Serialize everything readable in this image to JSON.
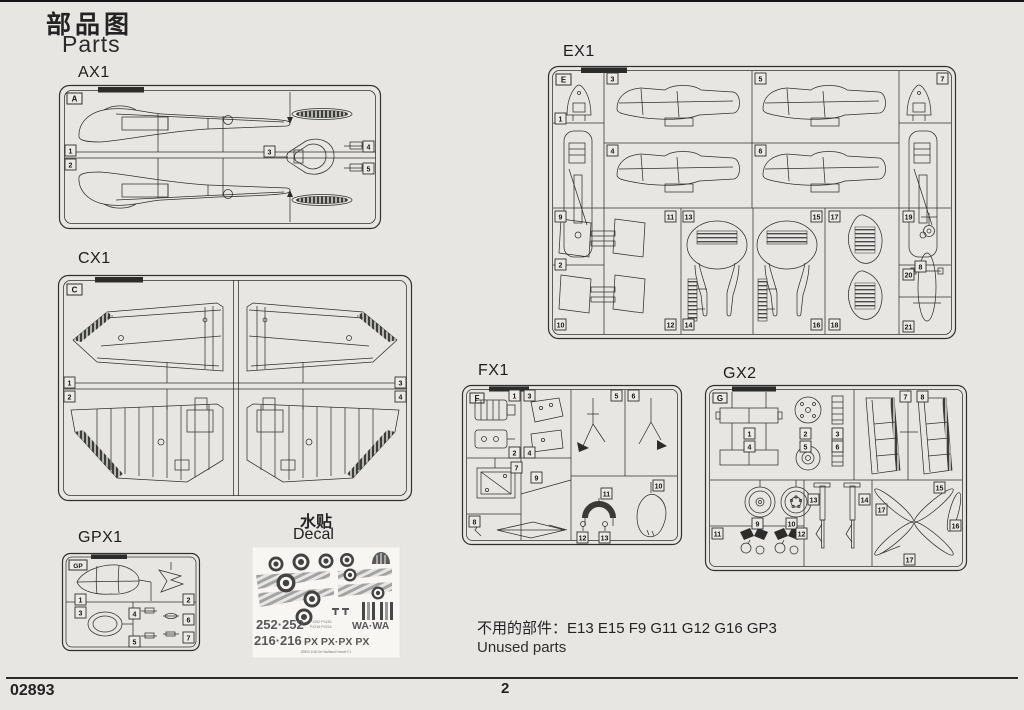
{
  "page": {
    "title_cn": "部品图",
    "title_en": "Parts",
    "product_code": "02893",
    "page_number": "2"
  },
  "colors": {
    "paper": "#e8e6e2",
    "ink": "#30302e",
    "decal_gray": "#9b9b9b",
    "decal_text": "#585858"
  },
  "sprues": {
    "ax1": {
      "label": "AX1",
      "corner_letter": "A",
      "parts": [
        "1",
        "2",
        "3",
        "4",
        "5"
      ]
    },
    "cx1": {
      "label": "CX1",
      "corner_letter": "C",
      "parts": [
        "1",
        "2",
        "3",
        "4"
      ]
    },
    "ex1": {
      "label": "EX1",
      "corner_letter": "E",
      "parts": [
        "1",
        "2",
        "3",
        "4",
        "5",
        "6",
        "7",
        "8",
        "9",
        "10",
        "11",
        "12",
        "13",
        "14",
        "15",
        "16",
        "17",
        "18",
        "19",
        "20",
        "21"
      ]
    },
    "fx1": {
      "label": "FX1",
      "corner_letter": "F",
      "parts": [
        "1",
        "2",
        "3",
        "4",
        "5",
        "6",
        "7",
        "8",
        "9",
        "10",
        "11",
        "12",
        "13"
      ]
    },
    "gx2": {
      "label": "GX2",
      "corner_letter": "G",
      "parts": [
        "1",
        "2",
        "3",
        "4",
        "5",
        "6",
        "7",
        "8",
        "9",
        "10",
        "11",
        "12",
        "13",
        "14",
        "15",
        "16",
        "17"
      ]
    },
    "gpx1": {
      "label": "GPX1",
      "corner_letter": "GP",
      "parts": [
        "1",
        "2",
        "3",
        "4",
        "5",
        "6",
        "7"
      ]
    }
  },
  "decal": {
    "label_cn": "水贴",
    "label_en": "Decal",
    "serial_row1_left": "252·252",
    "serial_row1_right": "WA·WA",
    "serial_row2_left": "216·216",
    "serial_row2_right": "PX PX·PX PX",
    "stencil_line1": "PX252·PX252",
    "stencil_line2": "PX216·PX216",
    "sheet_footer": "02893 1/48 De Havilland Hornet F.1"
  },
  "unused": {
    "text_cn": "不用的部件：E13 E15 F9 G11 G12 G16 GP3",
    "text_en": "Unused parts"
  }
}
